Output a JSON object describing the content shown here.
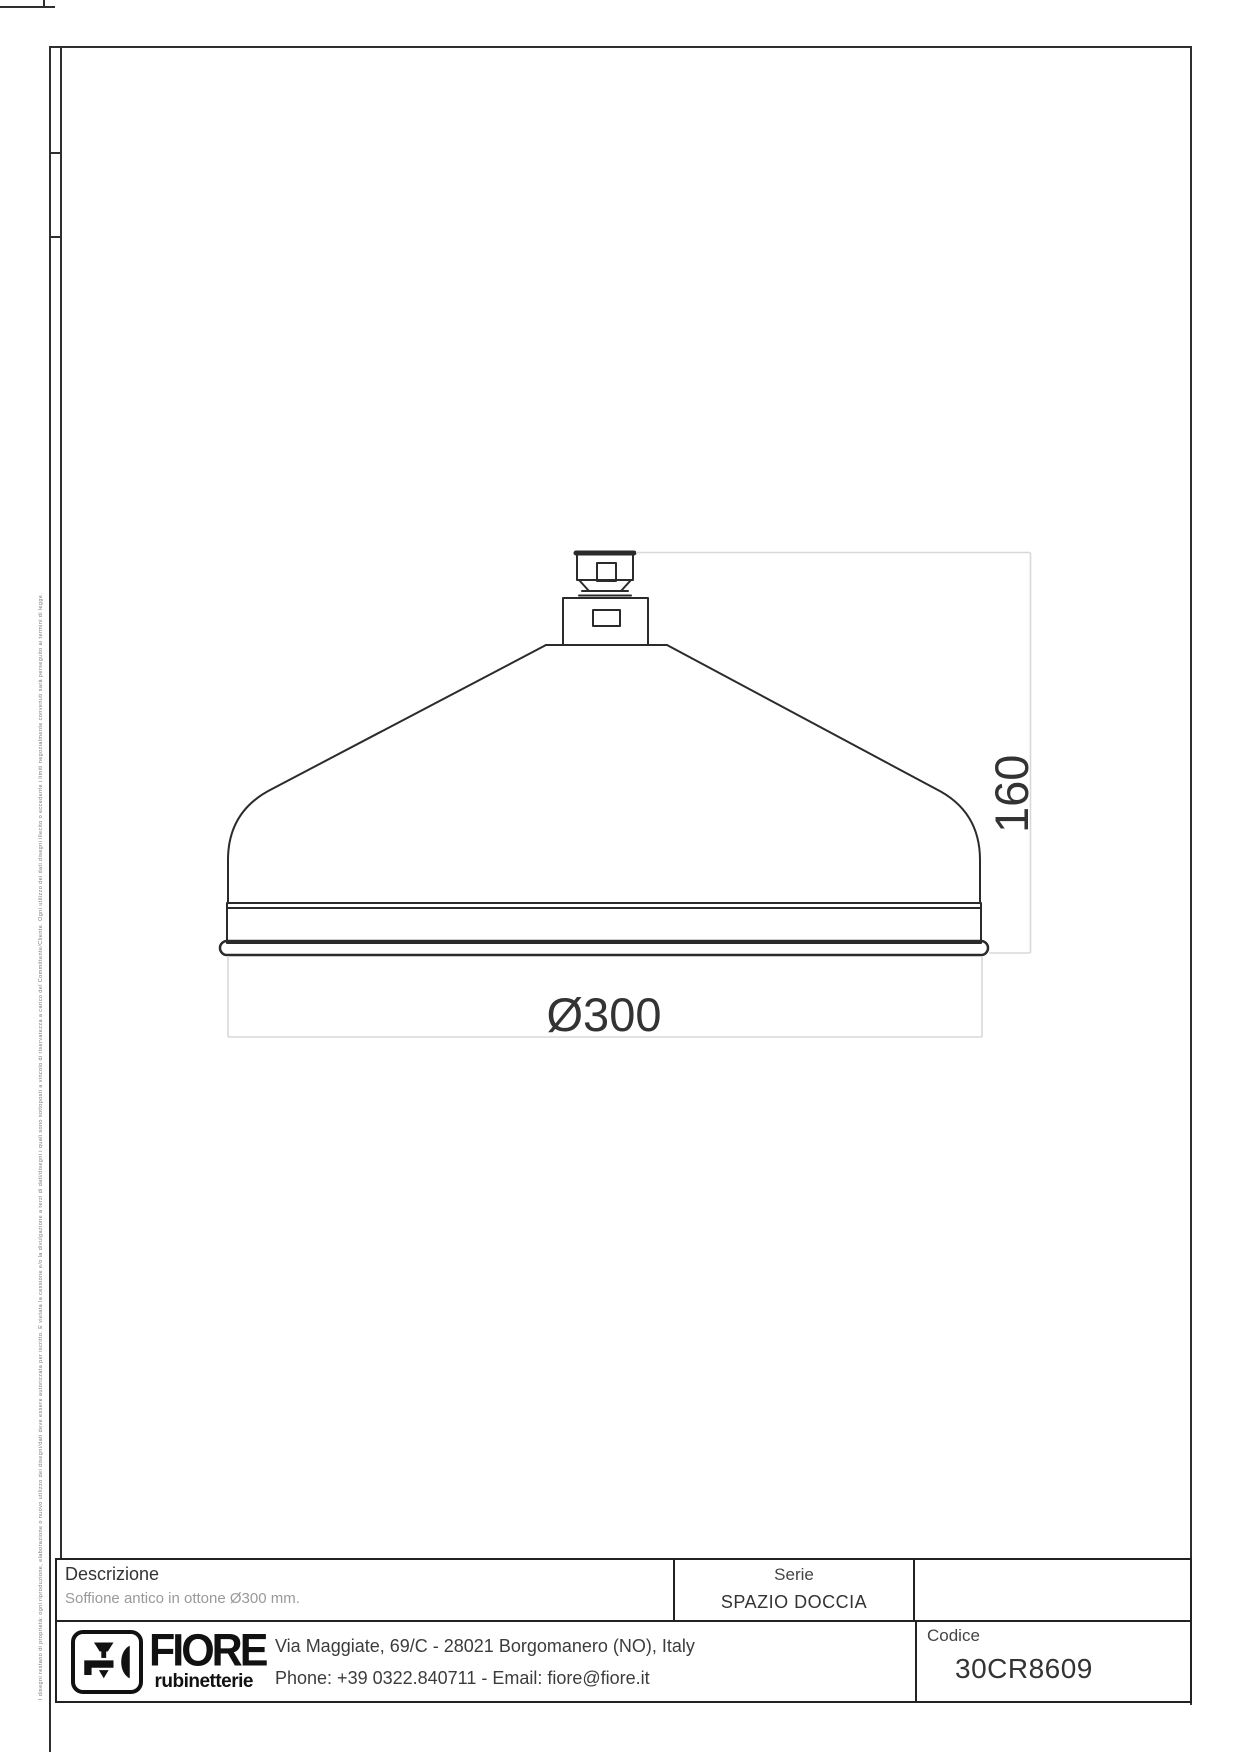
{
  "document": {
    "disclaimer": "I disegni restano di proprietà: ogni riproduzione, elaborazione o nuovo utilizzo dei disegni/dati deve essere autorizzata per iscritto. È vietata la cessione e/o la divulgazione a terzi di dati/disegni i quali sono sottoposti a vincolo di riservatezza a carico del Committente/Cliente. Ogni utilizzo dei dati disegni illecito o eccedente i limiti negozialmente convenuti sarà perseguito ai termini di legge."
  },
  "drawing": {
    "dim_height": "160",
    "dim_diameter": "Ø300",
    "colors": {
      "stroke": "#2b2b2b",
      "dim_line": "#d8d8d8",
      "dim_text": "#333333"
    }
  },
  "title_block": {
    "descrizione": {
      "label": "Descrizione",
      "value": "Soffione antico in ottone Ø300 mm."
    },
    "serie": {
      "label": "Serie",
      "value": "SPAZIO DOCCIA"
    },
    "codice": {
      "label": "Codice",
      "value": "30CR8609"
    },
    "company": {
      "brand": "FIORE",
      "brand_sub": "rubinetterie",
      "address": "Via Maggiate, 69/C - 28021 Borgomanero (NO), Italy",
      "contacts": "Phone: +39 0322.840711 - Email: fiore@fiore.it"
    }
  }
}
